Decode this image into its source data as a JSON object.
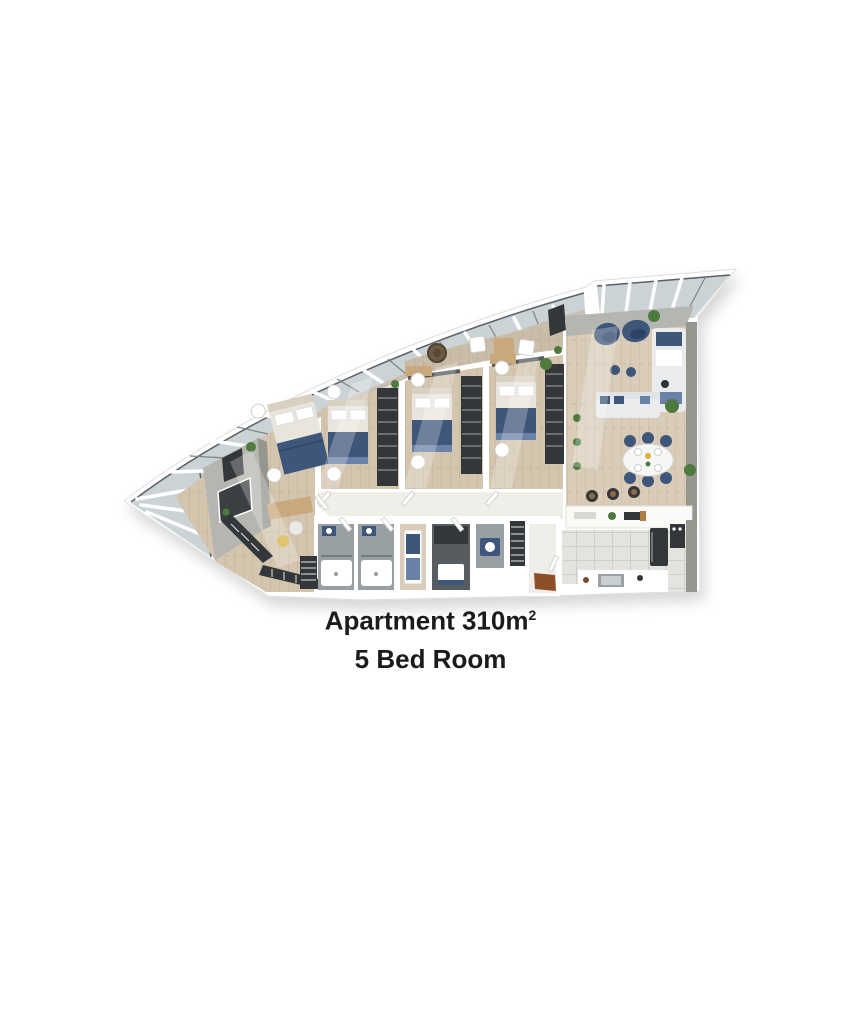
{
  "caption": {
    "title_main": "Apartment 310m",
    "title_sup": "2",
    "subtitle": "5 Bed Room"
  },
  "colors": {
    "wall": "#ffffff",
    "glass": "#ccd3d6",
    "frame_dark": "#5a6065",
    "floor_wood": "#d3c5ae",
    "floor_wood_light": "#d9ccb8",
    "floor_balcony": "#c9bda9",
    "floor_gray": "#99a0a3",
    "floor_gray_dark": "#565c5f",
    "floor_tile": "#e4e3df",
    "floor_hall": "#efeee9",
    "wall_gray": "#b5b5b1",
    "wall_gray_dark": "#96968f",
    "navy": "#3e5679",
    "navy_dark": "#2e4265",
    "blue_soft": "#6a82a8",
    "mattress": "#eae5dc",
    "sofa_light": "#e9ebed",
    "wood_furniture": "#c8a87c",
    "dark_unit": "#34373a",
    "plant": "#4f7a3f",
    "mat_brown": "#8d4e28",
    "accent_yellow": "#d9b13e",
    "headboard": "#d8d1c2",
    "beige_wall": "#c7c0b2",
    "text": "#1b1b1b"
  }
}
